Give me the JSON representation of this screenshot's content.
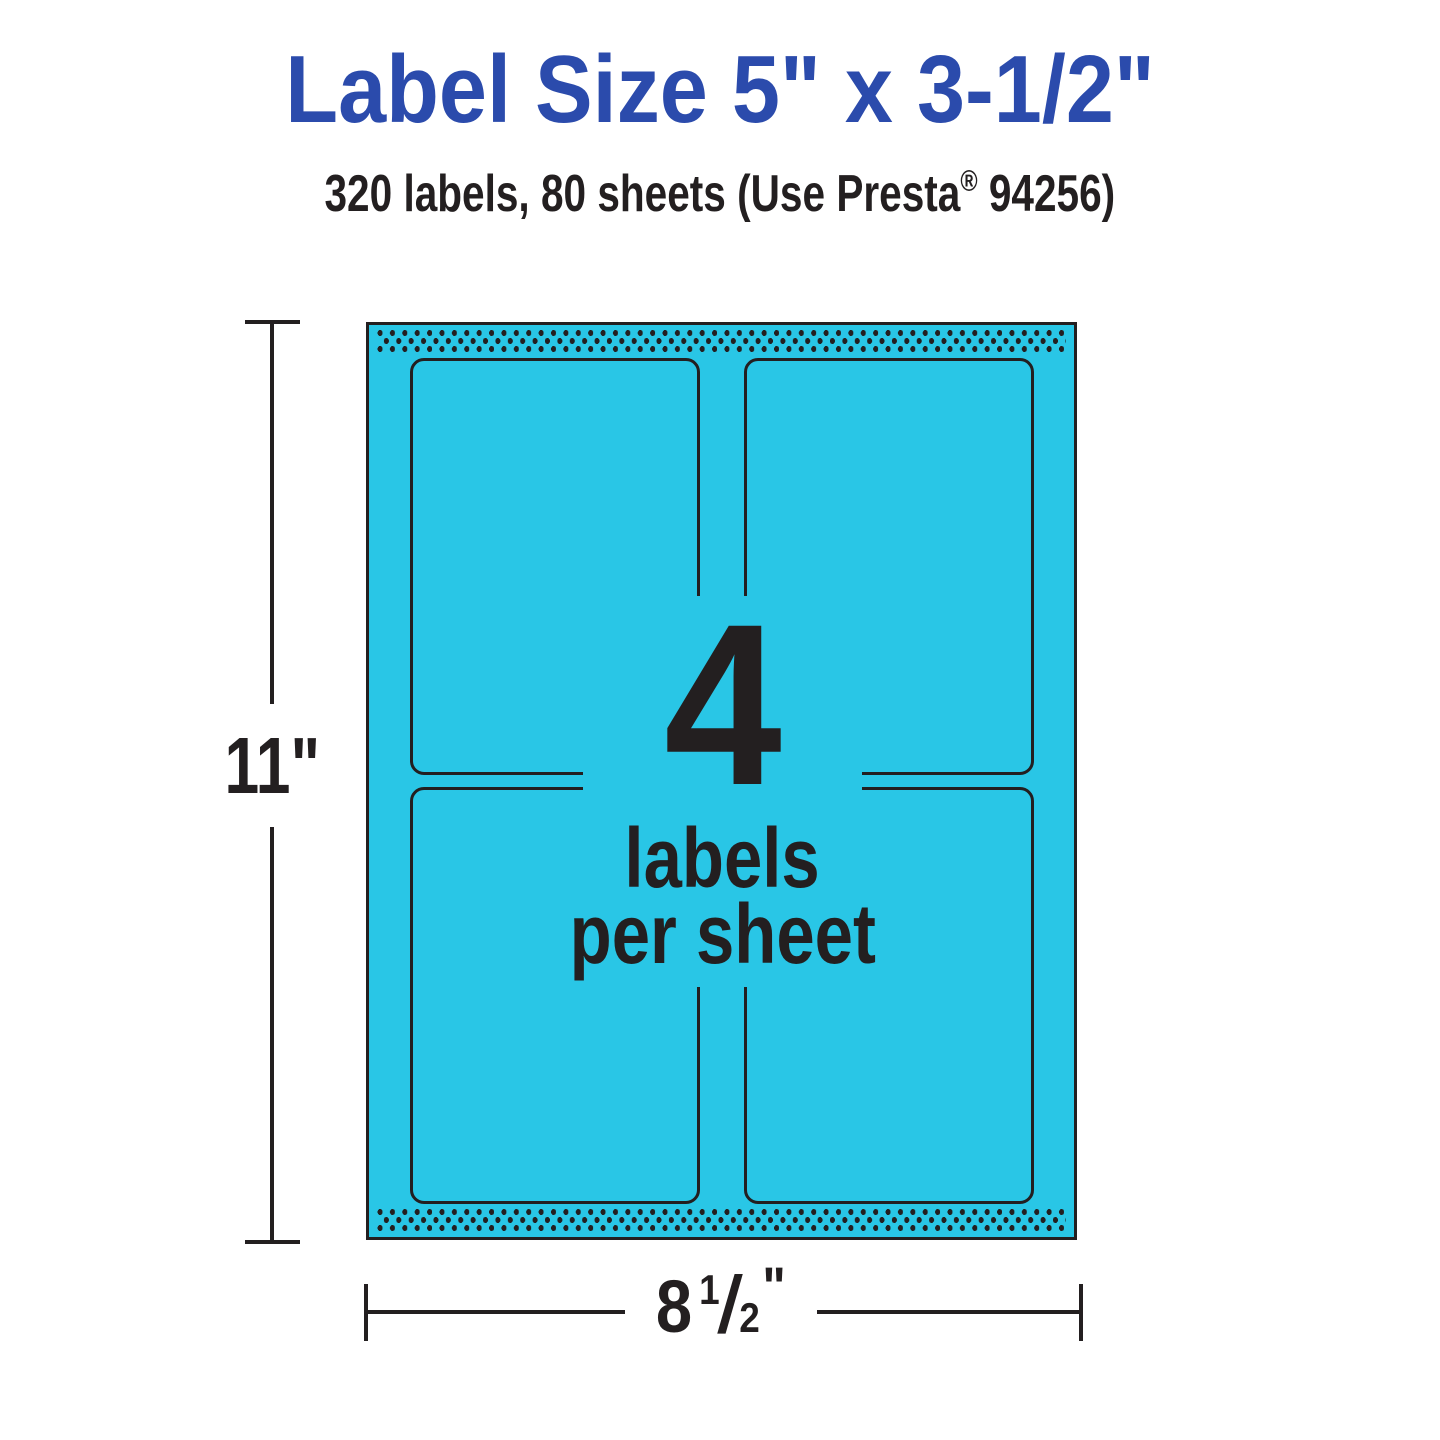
{
  "header": {
    "title": "Label Size 5\" x 3-1/2\"",
    "subtitle_part1": "320 labels, 80 sheets (Use Presta",
    "subtitle_reg_mark": "®",
    "subtitle_part2": " 94256)"
  },
  "sheet_diagram": {
    "labels_per_sheet_count": "4",
    "callout_line1": "labels",
    "callout_line2": "per sheet",
    "grid": {
      "rows": 2,
      "columns": 2
    },
    "height_dimension": "11\"",
    "width_dimension": {
      "whole": "8",
      "numerator": "1",
      "slash": "/",
      "denominator": "2",
      "unit": "\""
    }
  },
  "colors": {
    "title_blue": "#2B4BAC",
    "sheet_cyan": "#29C6E6",
    "ink": "#231F20"
  }
}
